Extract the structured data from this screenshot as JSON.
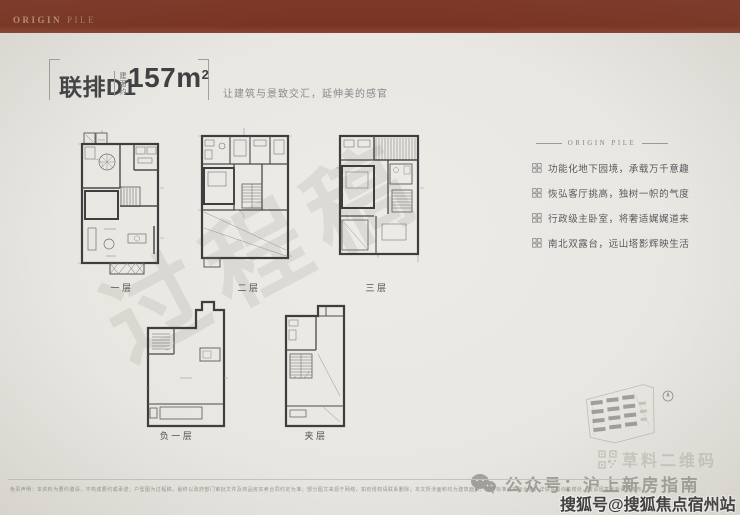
{
  "topbar": {
    "brand_primary": "ORIGIN",
    "brand_secondary": "PILE"
  },
  "header": {
    "title": "联排D1",
    "area_label": "建面约",
    "area_value": "157",
    "area_unit": "m",
    "area_sup": "2",
    "subtitle": "让建筑与景致交汇，延伸美的感官"
  },
  "features": {
    "heading": "ORIGIN PILE",
    "items": [
      "功能化地下园境，承载万千意趣",
      "恢弘客厅挑高，独树一帜的气度",
      "行政级主卧室，将奢适娓娓道来",
      "南北双露台，远山塔影辉映生活"
    ]
  },
  "plans": {
    "labels": [
      "一层",
      "二层",
      "三层",
      "负一层",
      "夹层"
    ]
  },
  "watermarks": {
    "draft": "过程稿",
    "qr": "草料二维码",
    "wechat": "公众号：沪上新房指南",
    "sohu": "搜狐号@搜狐焦点宿州站"
  },
  "footer": {
    "disclaimer": "免责声明：本资料为要约邀请，不构成要约或承诺；户型图为过程稿，最终以政府部门审批文件及商品房买卖合同约定为准；部分图文来源于网络，如有侵权请联系删除；本文所涉面积均为建筑面积，交付标准以实际为准；详情请垂询售楼处，敬请留意最新资讯发布。"
  },
  "colors": {
    "brand_maroon": "#7a3322",
    "background": "#e9e7e2",
    "ink": "#3f3f41",
    "muted": "#88888a",
    "watermark_gray": "#a09c93"
  }
}
